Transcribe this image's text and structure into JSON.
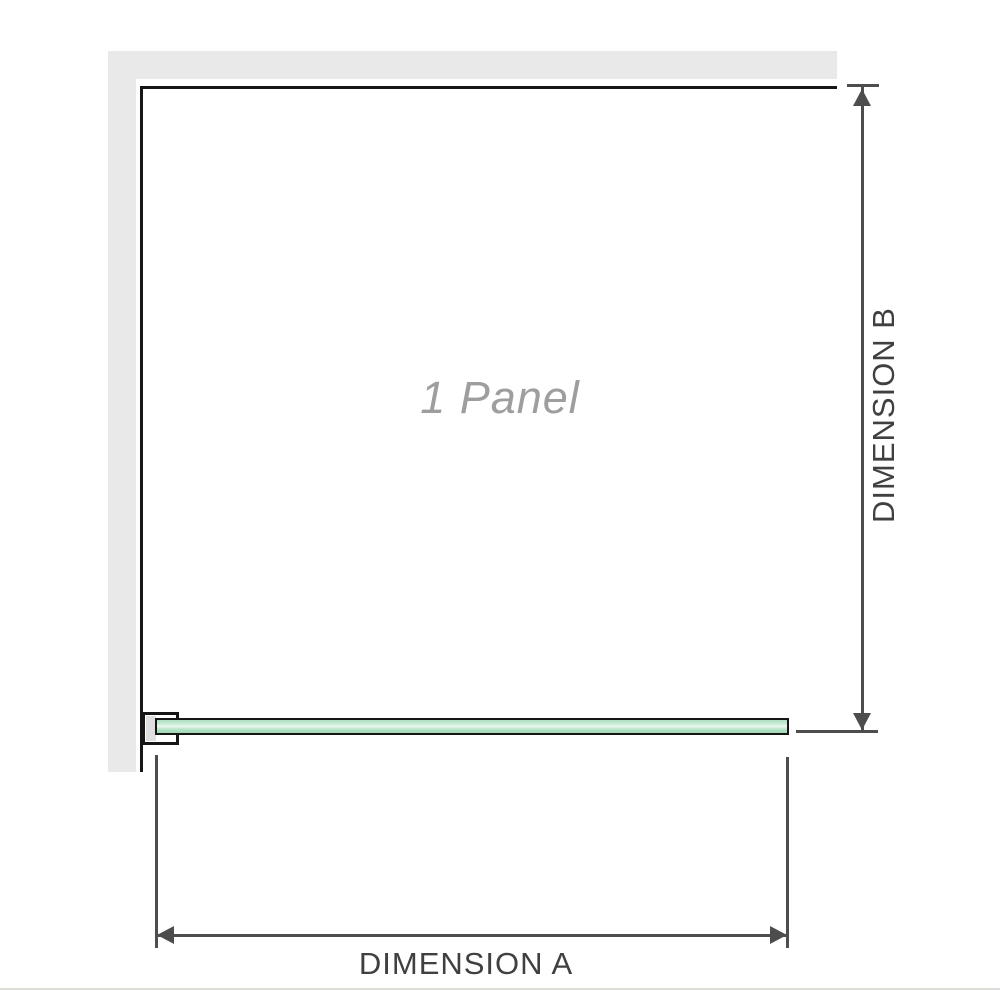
{
  "labels": {
    "panel": "1 Panel",
    "dimension_a": "DIMENSION A",
    "dimension_b": "DIMENSION B"
  },
  "colors": {
    "wall_gray": "#e9e9e9",
    "panel_edge_black": "#161616",
    "bracket_gray": "#dfdfdf",
    "glass_green": "#aedfc0",
    "glass_green_highlight": "#ecf9f1",
    "glass_green_dark": "#a0d7b4",
    "dimension_gray": "#4d4d4d",
    "panel_label_gray": "#9e9e9e",
    "label_dark_gray": "#404040",
    "baseline_gray": "#dedcd4"
  }
}
